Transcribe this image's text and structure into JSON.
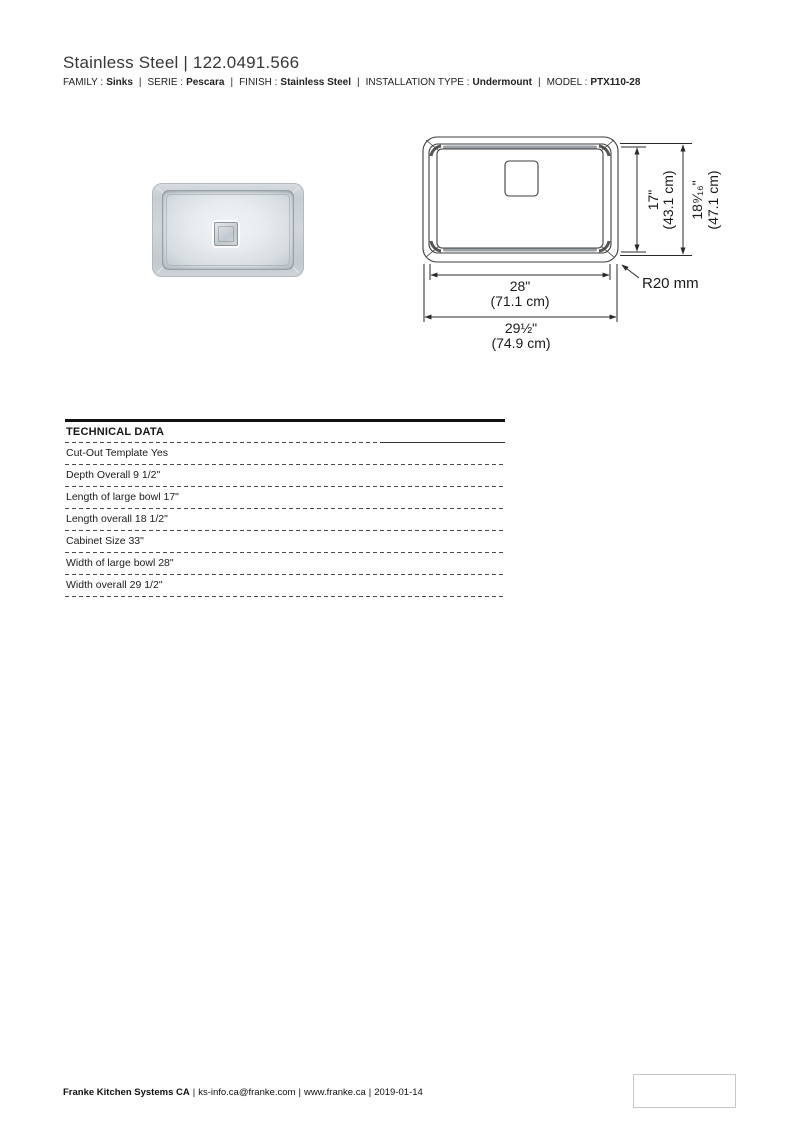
{
  "header": {
    "title": "Stainless Steel | 122.0491.566",
    "separator": "|",
    "meta": [
      {
        "label": "FAMILY :",
        "value": "Sinks"
      },
      {
        "label": "SERIE :",
        "value": "Pescara"
      },
      {
        "label": "FINISH :",
        "value": "Stainless Steel"
      },
      {
        "label": "INSTALLATION TYPE :",
        "value": "Undermount"
      },
      {
        "label": "MODEL :",
        "value": "PTX110-28"
      }
    ]
  },
  "drawing": {
    "width_inner": {
      "inches": "28\"",
      "cm": "(71.1 cm)"
    },
    "width_overall": {
      "inches": "29½\"",
      "cm": "(74.9 cm)"
    },
    "depth_inner": {
      "inches": "17\"",
      "cm": "(43.1 cm)"
    },
    "depth_overall": {
      "inches": "18⁹⁄₁₆\"",
      "cm": "(47.1 cm)"
    },
    "corner_radius_label": "R20 mm"
  },
  "table": {
    "header": "TECHNICAL DATA",
    "rows": [
      {
        "label": "Cut-Out Template",
        "value": "Yes"
      },
      {
        "label": "Depth Overall",
        "value": "9 1/2\""
      },
      {
        "label": "Length of large bowl",
        "value": "17\""
      },
      {
        "label": "Length overall",
        "value": "18 1/2\""
      },
      {
        "label": "Cabinet Size",
        "value": "33\""
      },
      {
        "label": "Width of large bowl",
        "value": "28\""
      },
      {
        "label": "Width overall",
        "value": "29 1/2\""
      }
    ]
  },
  "footer": {
    "company": "Franke Kitchen Systems CA",
    "separator": "|",
    "email": "ks-info.ca@franke.com",
    "website": "www.franke.ca",
    "date": "2019-01-14"
  }
}
